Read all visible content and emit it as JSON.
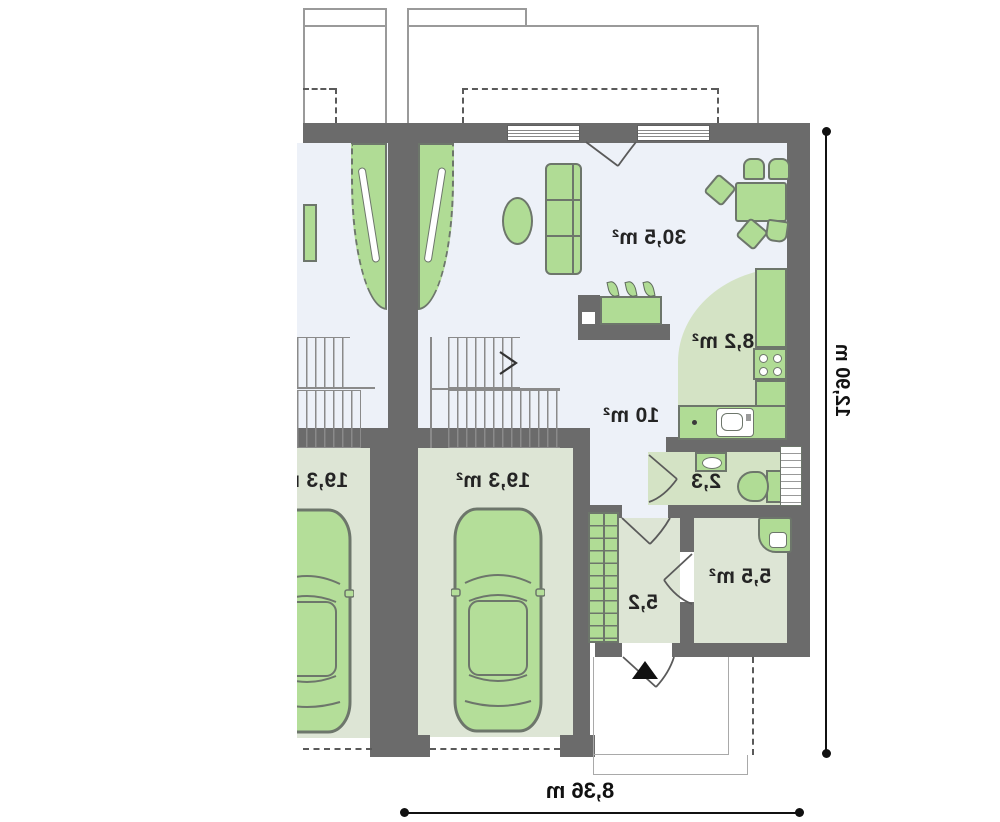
{
  "plan": {
    "rooms": {
      "living_room": {
        "area_label": "30,5 m²"
      },
      "kitchen": {
        "area_label": "8,2 m²"
      },
      "hall": {
        "area_label": "10 m²"
      },
      "wc": {
        "area_label": "2,3"
      },
      "garage_right": {
        "area_label": "19,3 m²"
      },
      "garage_left": {
        "area_label": "19,3 m²"
      },
      "utility_room": {
        "area_label": "5,5 m²"
      },
      "entry_hall": {
        "area_label": "5,2"
      }
    },
    "dimensions": {
      "total_height_label": "12,90 m",
      "total_width_label": "8,36 m"
    },
    "colors": {
      "wall": "#6b6b6b",
      "floor_light": "#edf1f8",
      "floor_green": "#d4e3c5",
      "floor_sage": "#dde5d5",
      "furniture_green": "#b0dc95",
      "dimension": "#111111"
    }
  }
}
